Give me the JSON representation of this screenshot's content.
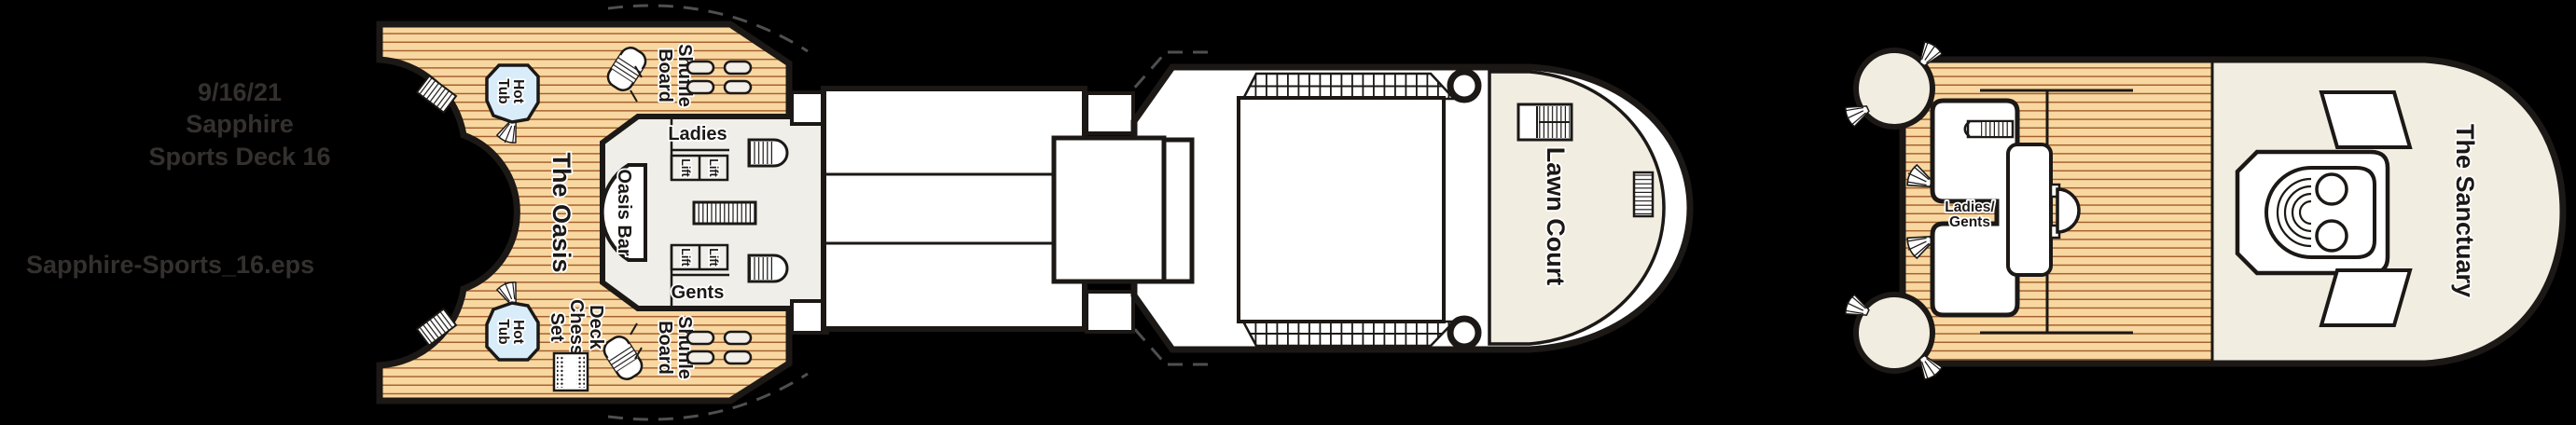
{
  "header": {
    "date": "9/16/21",
    "ship": "Sapphire",
    "deck": "Sports Deck 16",
    "filename": "Sapphire-Sports_16.eps"
  },
  "labels": {
    "the_oasis": "The Oasis",
    "oasis_bar": "Oasis Bar",
    "lawn_court": "Lawn Court",
    "the_sanctuary": "The Sanctuary",
    "ladies": "Ladies",
    "gents": "Gents",
    "lift": "Lift",
    "ladies_gents": [
      "Ladies/",
      "Gents"
    ],
    "hot_tub": [
      "Hot",
      "Tub"
    ],
    "shuffle_board": [
      "Shuffle",
      "Board"
    ],
    "deck_chess_set": [
      "Deck",
      "Chess",
      "Set"
    ]
  },
  "colors": {
    "bg": "#000000",
    "wood": "#f8d7a1",
    "plank": "#a5602c",
    "structure": "#f0eee8",
    "cream": "#f2ede1",
    "hottub": "#d9ecfa",
    "bench": "#f2efe8",
    "outline": "#1b1816",
    "dash": "#4f4f4f",
    "header": "#34302e"
  }
}
